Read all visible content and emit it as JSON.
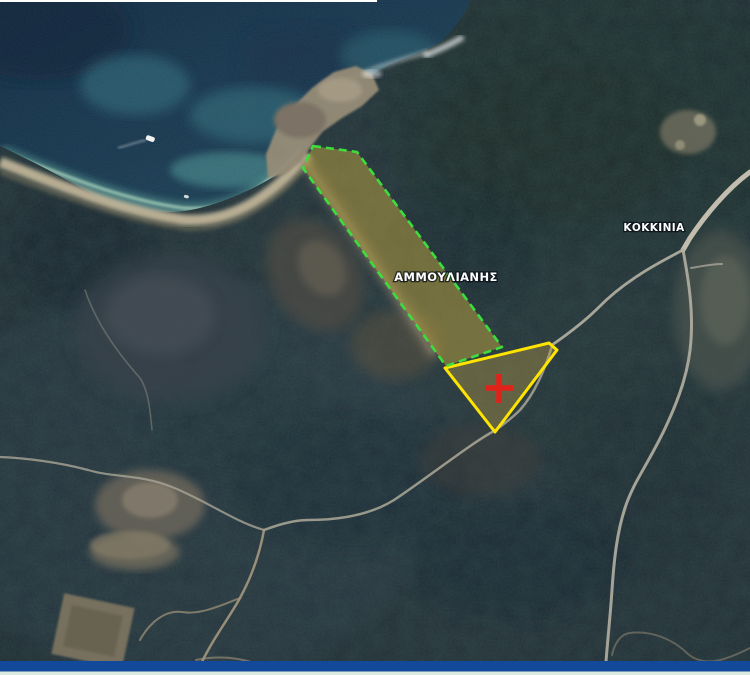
{
  "map": {
    "kind": "satellite-map",
    "labels": {
      "ammoulianis": "ΑΜΜΟΥΛΙΑΝΗΣ",
      "kokkinia": "ΚΟΚΚΙΝΙΑ"
    },
    "overlays": {
      "dashed_parcel": {
        "name": "ammoulianis-parcel-dashed-boundary",
        "stroke": "#3ddd3d",
        "fill": "rgba(178,156,64,0.55)"
      },
      "selected_parcel": {
        "name": "highlighted-parcel-boundary",
        "stroke": "#ffe400",
        "fill": "rgba(190,160,70,0.38)"
      },
      "marker": {
        "type": "cross",
        "color": "#e0231a"
      }
    },
    "footer": {
      "bar_color": "#12499b",
      "strip_color": "#dcebe2"
    },
    "top_strip_color": "#ffffff"
  }
}
